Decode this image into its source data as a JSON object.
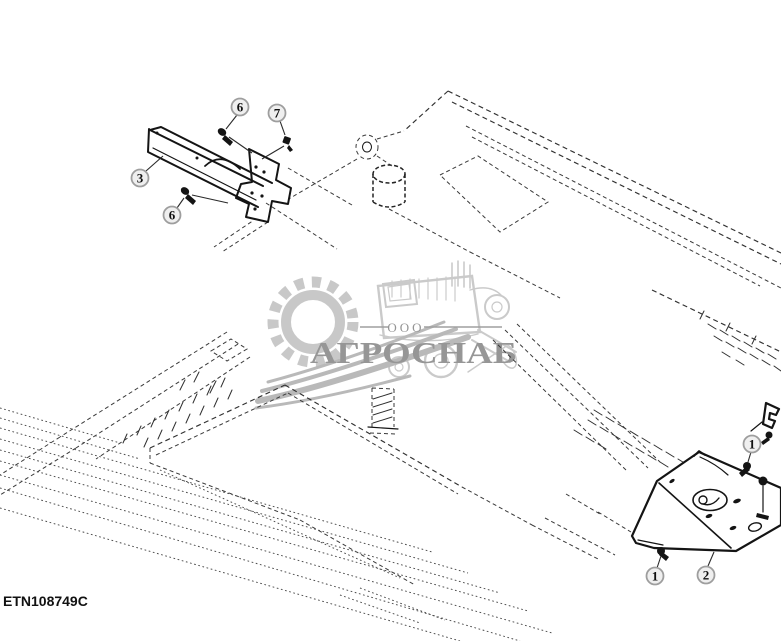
{
  "diagram": {
    "drawing_number": "ETN108749C",
    "callouts": [
      {
        "number": "3"
      },
      {
        "number": "6"
      },
      {
        "number": "7"
      },
      {
        "number": "6"
      },
      {
        "number": "1"
      },
      {
        "number": "1"
      },
      {
        "number": "2"
      }
    ]
  },
  "watermark": {
    "org_type": "ООО",
    "org_name": "АГРОСНАБ"
  },
  "colors": {
    "background": "#ffffff",
    "solid_part_line": "#141414",
    "hidden_line": "#3a3a3a",
    "callout_ring": "#9e9e9e",
    "watermark_gray": "#c8c8c8",
    "watermark_text": "#919191"
  }
}
